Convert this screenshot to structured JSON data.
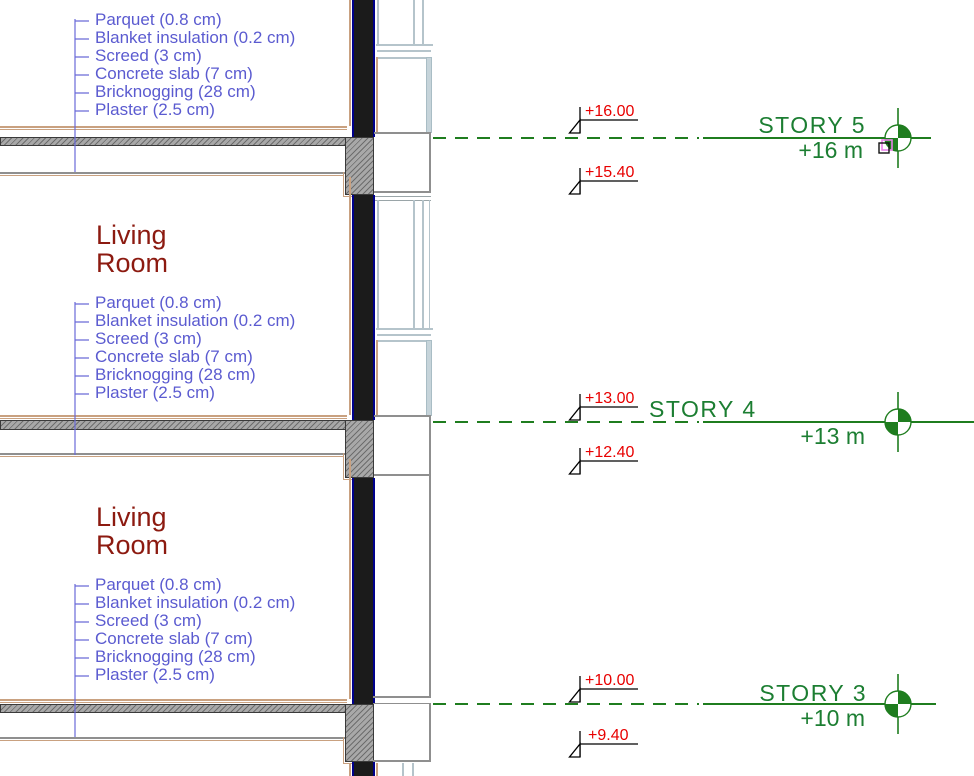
{
  "app_context": "architectural-section-view",
  "rooms": {
    "label_line1": "Living",
    "label_line2": "Room"
  },
  "floor_composition": {
    "items": [
      "Parquet (0.8 cm)",
      "Blanket insulation (0.2 cm)",
      "Screed (3 cm)",
      "Concrete slab (7 cm)",
      "Bricknogging (28 cm)",
      "Plaster (2.5 cm)"
    ]
  },
  "stories": [
    {
      "name": "STORY 5",
      "elevation_label": "+16 m",
      "level_top": "+16.00",
      "level_below": "+15.40"
    },
    {
      "name": "STORY 4",
      "elevation_label": "+13 m",
      "level_top": "+13.00",
      "level_below": "+12.40"
    },
    {
      "name": "STORY 3",
      "elevation_label": "+10 m",
      "level_top": "+10.00",
      "level_below": "+9.40"
    }
  ],
  "colors": {
    "floor_label_blue": "#5b5bd0",
    "room_label_maroon": "#8c1a10",
    "elevation_red": "#e80000",
    "story_green": "#1c7e32",
    "level_line_green": "#1f7d1f",
    "wall_black": "#1b1b1b",
    "wall_edge_navy": "#00008b",
    "plaster_tan": "#c9a180",
    "slab_hatch_gray": "#a8a8a8",
    "window_frame_gray": "#b5c4cb"
  }
}
